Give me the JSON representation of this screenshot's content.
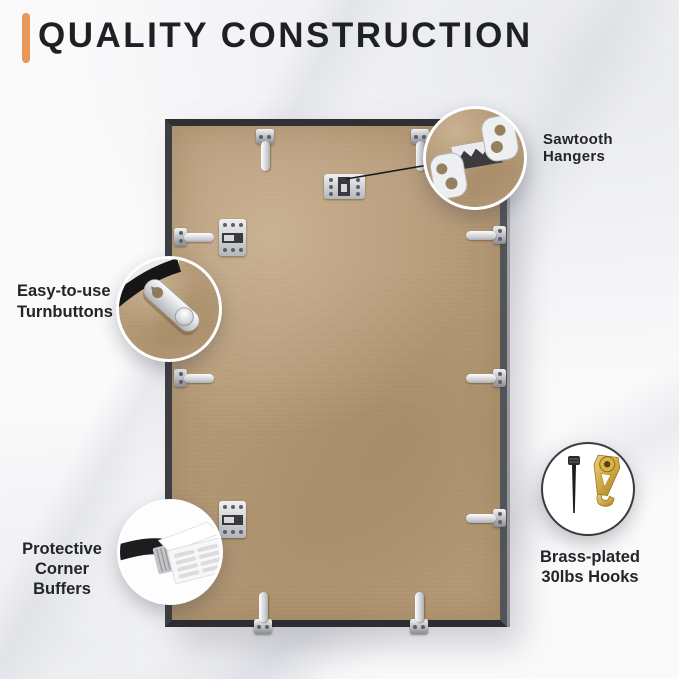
{
  "header": {
    "title": "QUALITY CONSTRUCTION",
    "accent_color": "#E9985C"
  },
  "callouts": {
    "sawtooth_hangers": {
      "label": "Sawtooth Hangers",
      "icon": "sawtooth-hanger-photo"
    },
    "turnbuttons": {
      "label_line1": "Easy-to-use",
      "label_line2": "Turnbuttons",
      "icon": "turnbutton-photo"
    },
    "corner_buffers": {
      "label_line1": "Protective",
      "label_line2": "Corner Buffers",
      "icon": "corner-buffer-photo"
    },
    "hooks": {
      "label_line1": "Brass-plated",
      "label_line2": "30lbs Hooks",
      "icon": "brass-hook-and-nail-photo"
    }
  },
  "scene": {
    "subject": "back of picture frame on marble surface",
    "frame_color": "#3C3E42",
    "board_color": "#B59A78",
    "hardware": [
      {
        "type": "turnbutton",
        "position": "top-left"
      },
      {
        "type": "turnbutton",
        "position": "top-right"
      },
      {
        "type": "sawtooth-hanger",
        "position": "top-center"
      },
      {
        "type": "turnbutton",
        "position": "left-upper"
      },
      {
        "type": "sawtooth-hanger",
        "position": "left-upper"
      },
      {
        "type": "turnbutton",
        "position": "right-upper"
      },
      {
        "type": "turnbutton",
        "position": "left-middle"
      },
      {
        "type": "turnbutton",
        "position": "right-middle"
      },
      {
        "type": "sawtooth-hanger",
        "position": "left-lower"
      },
      {
        "type": "turnbutton",
        "position": "right-lower"
      },
      {
        "type": "turnbutton",
        "position": "bottom-left"
      },
      {
        "type": "turnbutton",
        "position": "bottom-right"
      }
    ]
  },
  "colors": {
    "background_marble": "#FAFAFB",
    "marble_vein": "#CBCED8",
    "text": "#232428",
    "connector_line": "#1B1B1D",
    "brass": "#C9A13F",
    "metal": "#D9DBDE"
  }
}
